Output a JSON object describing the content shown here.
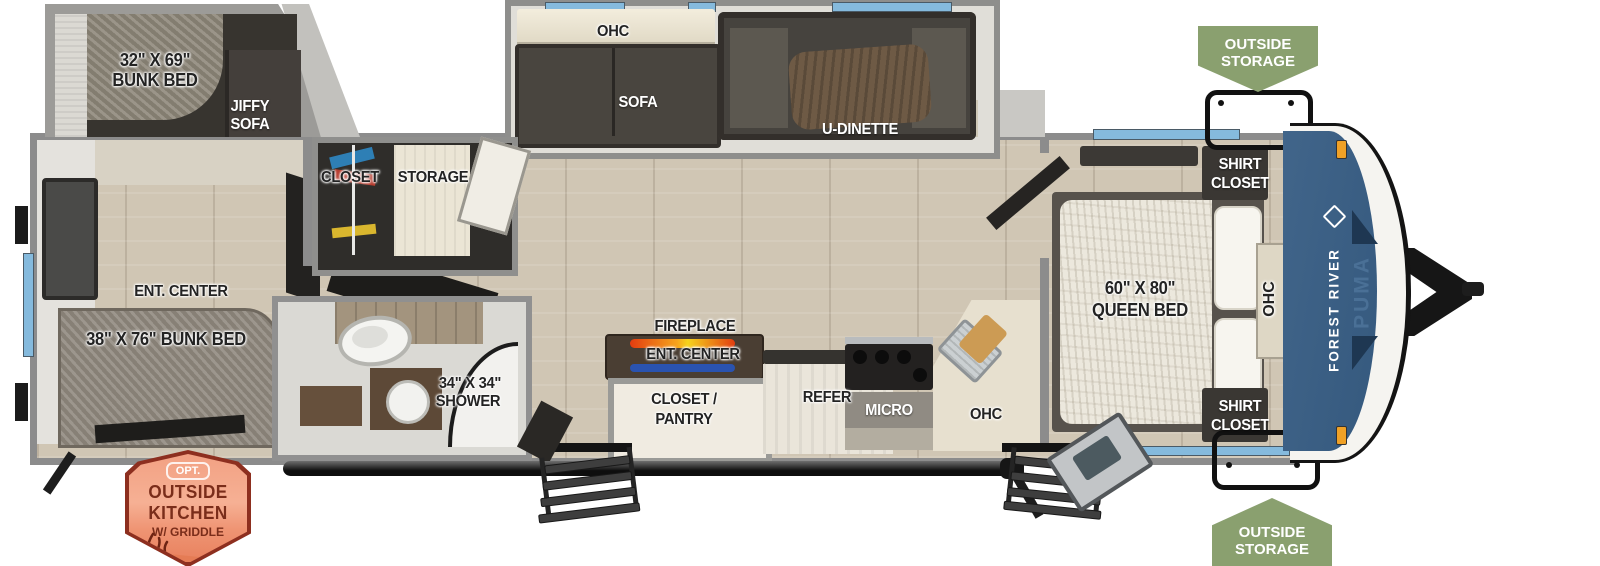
{
  "labels": {
    "bunk32_l1": "32\" X 69\"",
    "bunk32_l2": "BUNK BED",
    "jiffy_l1": "JIFFY",
    "jiffy_l2": "SOFA",
    "closet": "CLOSET",
    "storage": "STORAGE",
    "ohc_living": "OHC",
    "sofa": "SOFA",
    "u_dinette": "U-DINETTE",
    "ent_center_rear": "ENT. CENTER",
    "bunk38": "38\" X 76\" BUNK BED",
    "shower_l1": "34\" X 34\"",
    "shower_l2": "SHOWER",
    "fireplace": "FIREPLACE",
    "ent_center_main": "ENT. CENTER",
    "pantry_l1": "CLOSET /",
    "pantry_l2": "PANTRY",
    "refer": "REFER",
    "micro": "MICRO",
    "ohc_kitchen": "OHC",
    "queen_l1": "60\" X 80\"",
    "queen_l2": "QUEEN BED",
    "shirt_top_l1": "SHIRT",
    "shirt_top_l2": "CLOSET",
    "shirt_bottom_l1": "SHIRT",
    "shirt_bottom_l2": "CLOSET",
    "ohc_bedroom": "OHC"
  },
  "badges": {
    "storage_top_l1": "OUTSIDE",
    "storage_top_l2": "STORAGE",
    "storage_bottom_l1": "OUTSIDE",
    "storage_bottom_l2": "STORAGE",
    "kitchen_opt": "OPT.",
    "kitchen_l1": "OUTSIDE",
    "kitchen_l2": "KITCHEN",
    "kitchen_l3": "W/ GRIDDLE"
  },
  "branding": {
    "maker": "FOREST RIVER",
    "model": "PUMA"
  },
  "colors": {
    "cap_blue": "#3c5f84",
    "badge_green": "#8aa06f",
    "badge_orange_border": "#8d2f1f",
    "window_blue": "#85badd",
    "flame_orange": "#f07c1f",
    "wall_gray": "#8c8c8c"
  }
}
